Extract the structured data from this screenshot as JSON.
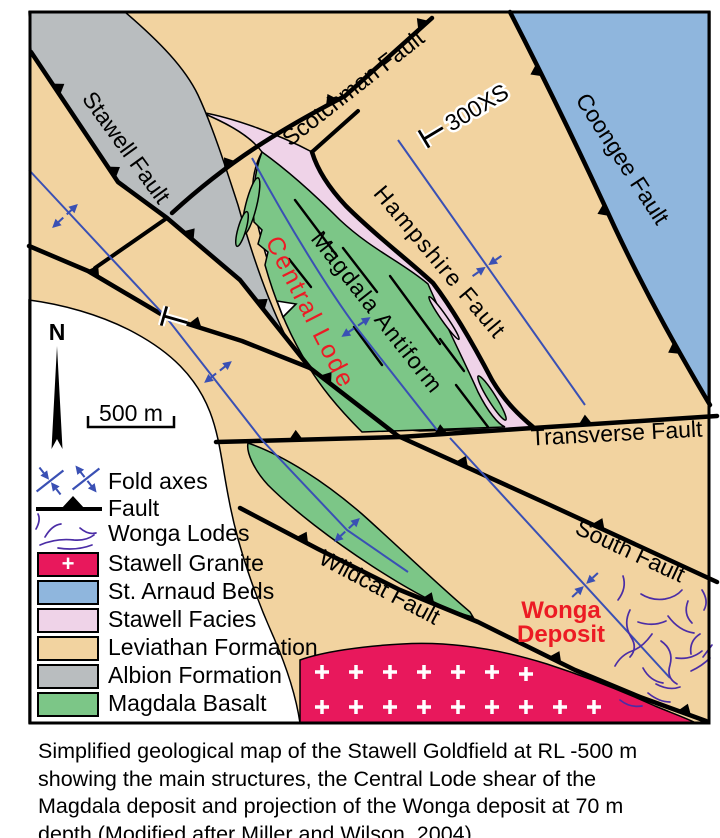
{
  "figure": {
    "labels": {
      "stawell_fault": "Stawell Fault",
      "scotchman_fault": "Scotchman Fault",
      "hampshire_fault": "Hampshire Fault",
      "coongee_fault": "Coongee Fault",
      "transverse_fault": "Transverse Fault",
      "south_fault": "South Fault",
      "wildcat_fault": "Wildcat Fault",
      "magdala_antiform": "Magdala Antiform",
      "central_lode": "Central Lode",
      "wonga_line1": "Wonga",
      "wonga_line2": "Deposit",
      "cross_section": "300XS",
      "north": "N",
      "scale_bar": "500 m"
    },
    "legend": {
      "items": [
        {
          "label": "Fold axes",
          "type": "fold-axes"
        },
        {
          "label": "Fault",
          "type": "fault"
        },
        {
          "label": "Wonga Lodes",
          "type": "lodes"
        },
        {
          "label": "Stawell Granite",
          "type": "swatch",
          "symbol": "+"
        },
        {
          "label": "St. Arnaud Beds",
          "type": "swatch"
        },
        {
          "label": "Stawell Facies",
          "type": "swatch"
        },
        {
          "label": "Leviathan Formation",
          "type": "swatch"
        },
        {
          "label": "Albion Formation",
          "type": "swatch"
        },
        {
          "label": "Magdala Basalt",
          "type": "swatch"
        }
      ]
    },
    "colors": {
      "leviathan": "#F2D3A0",
      "albion": "#B9BDBF",
      "magdala": "#7CC687",
      "facies": "#EFD3E8",
      "st_arnaud": "#8FB6DD",
      "granite": "#E8185C",
      "axis_blue": "#3A50B4",
      "lode_purple": "#4B2DA6",
      "label_red": "#EC1B24",
      "black": "#000000"
    },
    "caption": {
      "lines": [
        "Simplified geological map of the Stawell Goldfield at RL -500 m",
        "showing the main structures, the Central Lode shear of the",
        "Magdala deposit and projection of the Wonga deposit at 70 m",
        "depth (Modified after Miller and Wilson, 2004)."
      ]
    }
  }
}
